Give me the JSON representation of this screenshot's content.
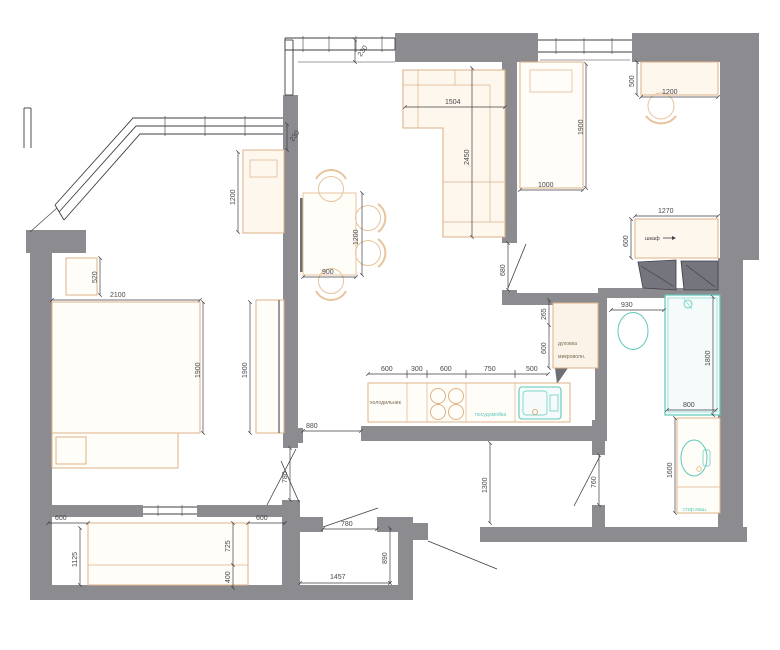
{
  "drawing_type": "apartment-floor-plan",
  "colors": {
    "wall": "#8b8b90",
    "wall_dark": "#6f6f76",
    "line": "#3f3f44",
    "furniture": "#dfb287",
    "furniture_fill": "#fdf7ee",
    "fixture_teal": "#5ec8bb",
    "fixture_fill": "#f4fbfa",
    "background": "#ffffff"
  },
  "labels": {
    "wardrobe": "шкаф",
    "oven": "духовка",
    "microwave": "микроволн.",
    "fridge": "холодильник",
    "dishwasher": "посудомойка",
    "washer": "стир.маш."
  },
  "dims": {
    "d230_kitchen": "230",
    "d230_living": "230",
    "d1200_cabinet": "1200",
    "d1504": "1504",
    "d2450": "2450",
    "d1200_table": "1200",
    "d900": "900",
    "d520": "520",
    "d2100": "2100",
    "d1900_bed": "1900",
    "d1900_wardrobe": "1900",
    "d680": "680",
    "d1900_bed2": "1900",
    "d1000": "1000",
    "d500_desk": "500",
    "d1200_desk": "1200",
    "d1270": "1270",
    "d600_closet": "600",
    "d930": "930",
    "d265": "265",
    "d600_oven": "600",
    "k600a": "600",
    "k300": "300",
    "k600b": "600",
    "k750": "750",
    "k500": "500",
    "d1800": "1800",
    "d800": "800",
    "d1600": "1600",
    "d880": "880",
    "d780_door": "780",
    "d780_corr": "780",
    "d1300": "1300",
    "d760": "760",
    "d890": "890",
    "d1457": "1457",
    "b600a": "600",
    "b1125": "1125",
    "b725": "725",
    "b400": "400",
    "b600b": "600"
  }
}
